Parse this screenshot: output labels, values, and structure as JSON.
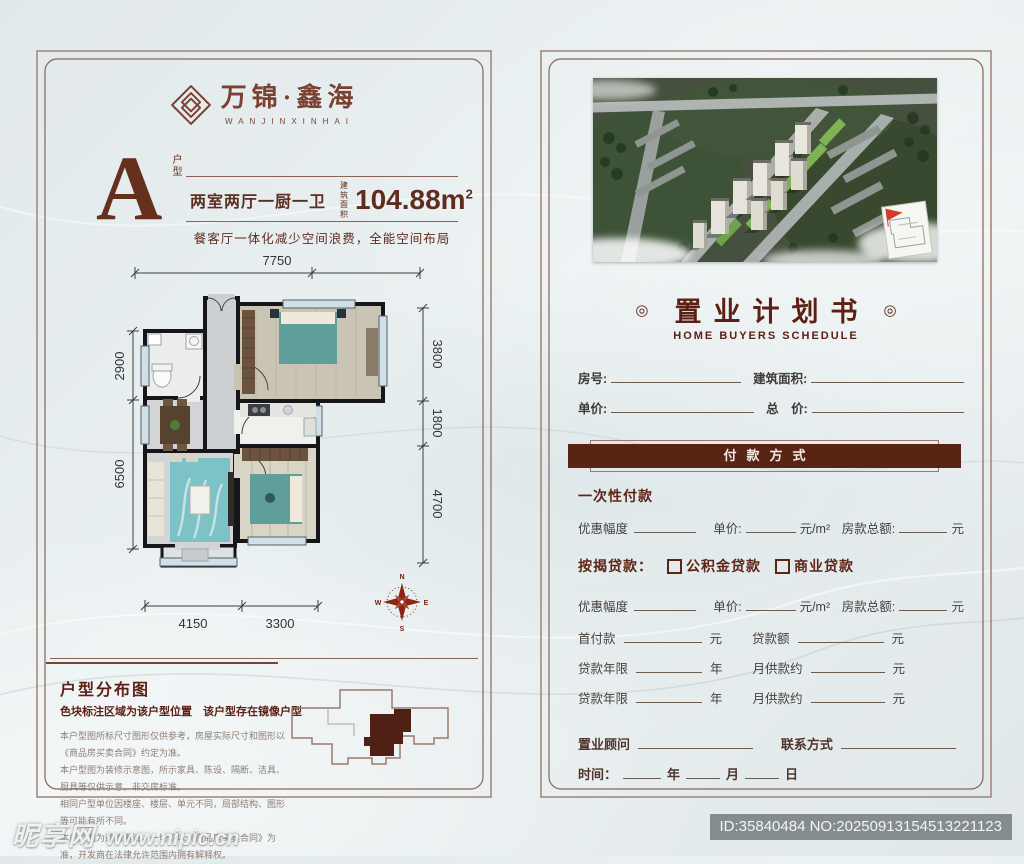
{
  "watermark": {
    "site": "昵享网",
    "url": "www.nipic.cn",
    "id": "ID:35840484 NO:20250913154513221123"
  },
  "left_page": {
    "logo": {
      "name": "万锦·鑫海",
      "latin": "WANJINXINHAI"
    },
    "unit": {
      "letter": "A",
      "tag": "户型",
      "rooms": "两室两厅一厨一卫",
      "area_label_top": "建筑",
      "area_label_bottom": "面积",
      "area_value": "104.88m",
      "area_sup": "2",
      "tagline": "餐客厅一体化减少空间浪费，全能空间布局"
    },
    "floorplan": {
      "dim_top": "7750",
      "dim_left_top": "2900",
      "dim_left_bottom": "6500",
      "dim_right_top": "3800",
      "dim_right_mid": "1800",
      "dim_right_bottom": "4700",
      "dim_bottom_left": "4150",
      "dim_bottom_right": "3300",
      "compass": {
        "n": "N",
        "e": "E",
        "s": "S",
        "w": "W"
      }
    },
    "distribution": {
      "title": "户型分布图",
      "subtitle": "色块标注区域为该户型位置　该户型存在镜像户型",
      "notes": [
        "本户型图所标尺寸图形仅供参考，房屋实际尺寸和图形以《商品房买卖合同》约定为准。",
        "本户型图为装修示意图，所示家具、陈设、隔断、洁具、厨具等仅供示意，非交房标准。",
        "相同户型单位因楼座、楼层、单元不同，局部结构、图形等可能有所不同。",
        "本户型图为邀约邀请，一切均以《商品房买卖合同》为准，开发商在法律允许范围内拥有解释权。"
      ]
    }
  },
  "right_page": {
    "title": "置业计划书",
    "deco": "◎",
    "subtitle": "HOME BUYERS SCHEDULE",
    "info": {
      "room": "房号:",
      "area": "建筑面积:",
      "unit_price": "单价:",
      "total": "总　价:"
    },
    "payment": {
      "banner": "付款方式",
      "one_time": "一次性付款",
      "mortgage": "按揭贷款：",
      "fund_loan": "公积金贷款",
      "biz_loan": "商业贷款",
      "discount": "优惠幅度",
      "unit_price": "单价:",
      "per_m2": "元/m²",
      "total": "房款总额:",
      "yuan": "元",
      "down": "首付款",
      "loan_amt": "贷款额",
      "years": "贷款年限",
      "year": "年",
      "monthly": "月供款约"
    },
    "footer": {
      "consultant": "置业顾问",
      "contact": "联系方式",
      "time": "时间：",
      "year": "年",
      "month": "月",
      "day": "日"
    }
  }
}
